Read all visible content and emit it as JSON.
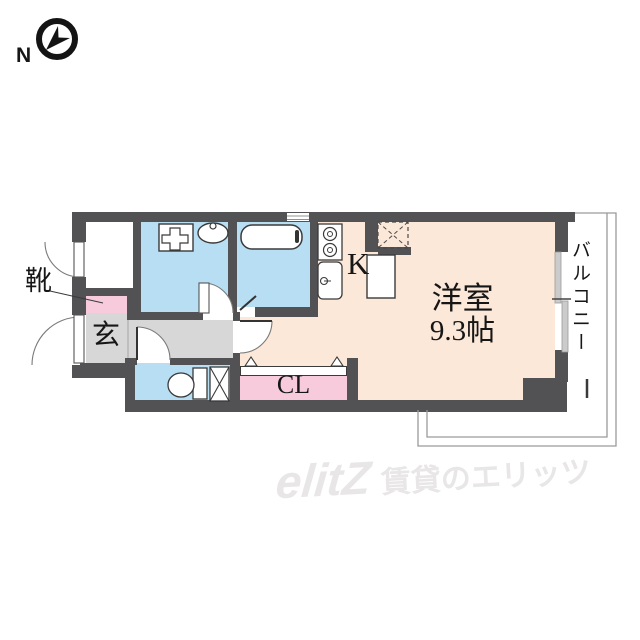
{
  "compass": {
    "north_label": "N"
  },
  "labels": {
    "shoes": "靴",
    "entrance": "玄",
    "kitchen": "K",
    "main_room_name": "洋室",
    "main_room_size": "9.3帖",
    "closet": "CL",
    "balcony": "バルコニー"
  },
  "watermark": {
    "logo": "elitZ",
    "tagline": "賃貸のエリッツ"
  },
  "colors": {
    "wall": "#525154",
    "wet_room_floor": "#b7def2",
    "hall_floor": "#d7d7d7",
    "storage_pink": "#f7cbdc",
    "living_floor": "#fce8d8",
    "balcony_line": "#9a9a9a",
    "watermark_gray": "#e8e6e6"
  },
  "fixtures": {
    "compass": "circle-with-north-arrow",
    "washing_machine": "square-with-cross",
    "washbasin": "oval-with-tap",
    "bathtub": "rounded-rect-with-tap",
    "stove": "two-burner-circles",
    "kitchen_sink": "rounded-rect-with-drain",
    "refrigerator_space": "dashed-box-with-x",
    "toilet": "bowl-with-tank-and-x-box",
    "closet_door": "folding-door-triangles"
  }
}
